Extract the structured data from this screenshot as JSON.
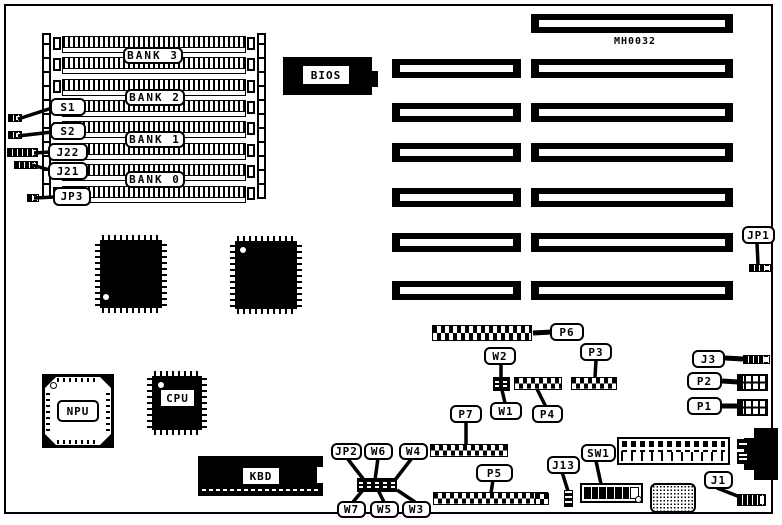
{
  "diagram": {
    "part_number": "MH0032",
    "memory_banks": [
      "BANK 3",
      "BANK 2",
      "BANK 1",
      "BANK 0"
    ],
    "chips": {
      "bios": "BIOS",
      "npu": "NPU",
      "cpu": "CPU",
      "kbd": "KBD"
    },
    "connector_labels": {
      "s1": "S1",
      "s2": "S2",
      "j22": "J22",
      "j21": "J21",
      "jp3": "JP3",
      "jp1": "JP1",
      "p6": "P6",
      "p3": "P3",
      "w2": "W2",
      "w1": "W1",
      "p4": "P4",
      "p7": "P7",
      "jp2": "JP2",
      "w6": "W6",
      "w4": "W4",
      "w7": "W7",
      "w5": "W5",
      "w3": "W3",
      "p5": "P5",
      "j13": "J13",
      "sw1": "SW1",
      "j1": "J1",
      "j3": "J3",
      "p2": "P2",
      "p1": "P1"
    },
    "colors": {
      "ink": "#000000",
      "paper": "#ffffff"
    }
  }
}
